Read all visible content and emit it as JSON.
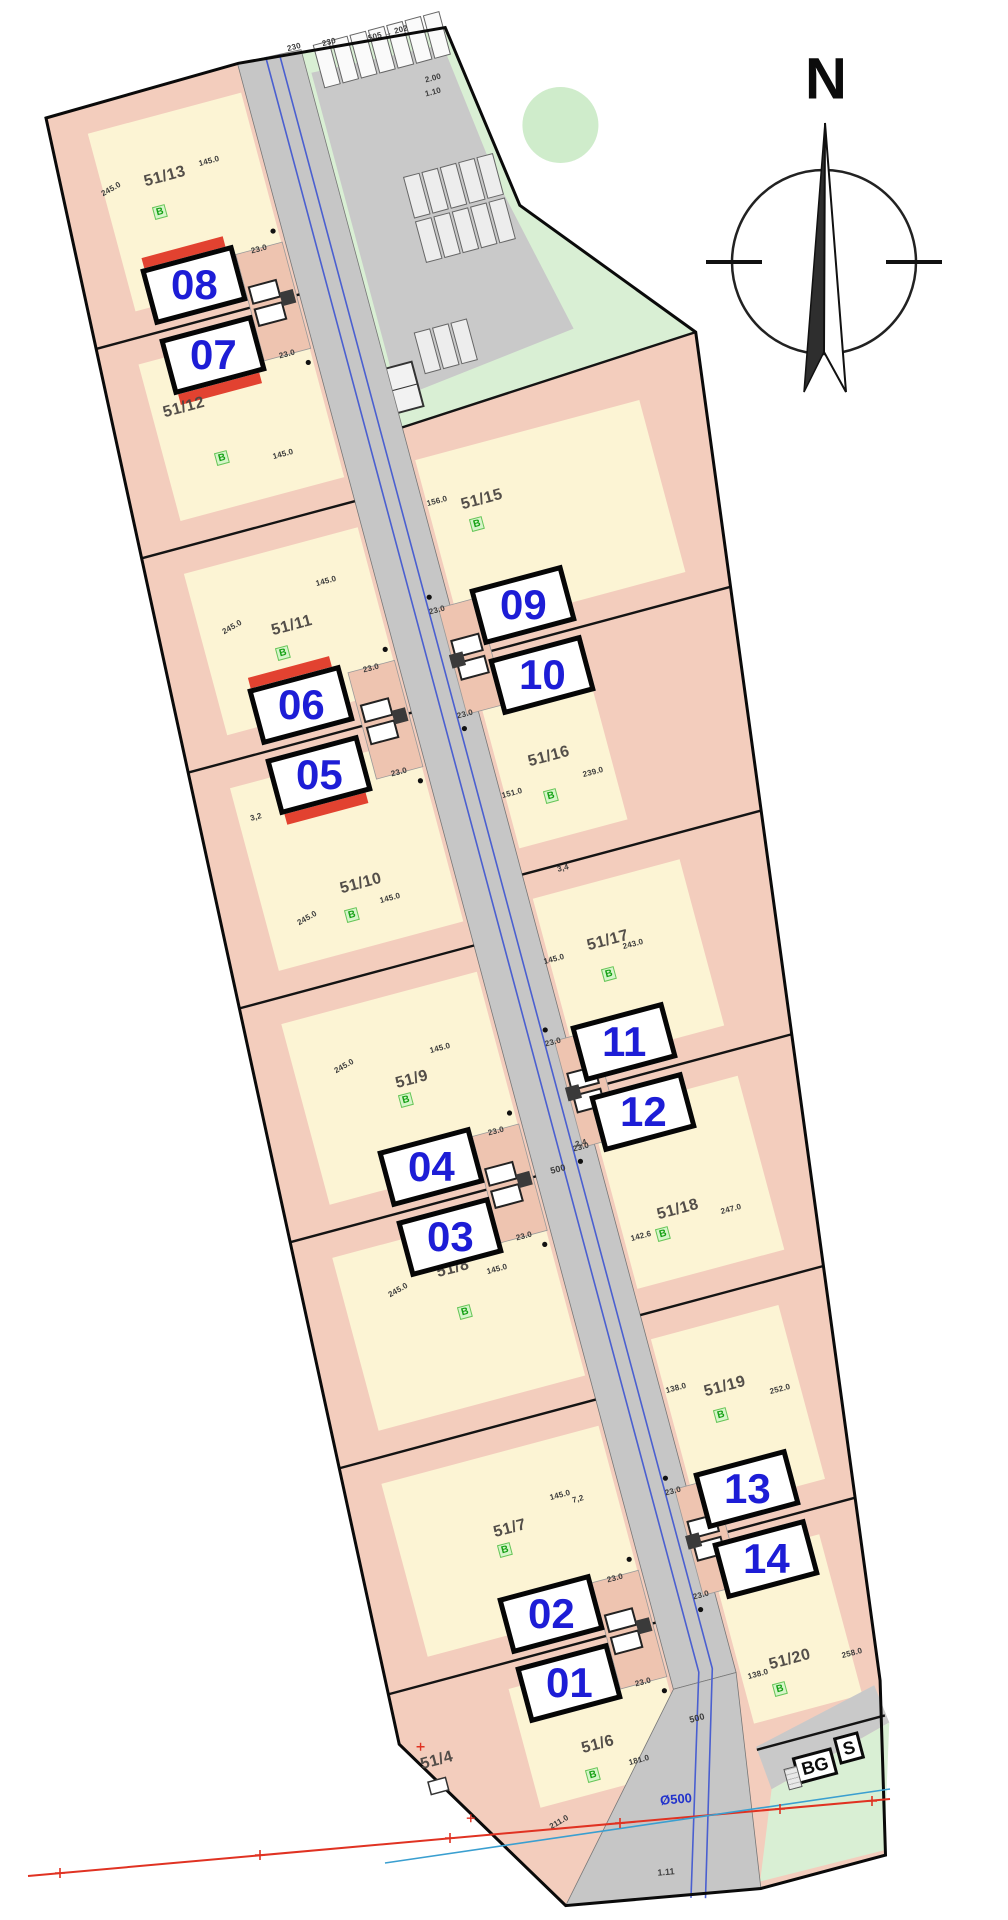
{
  "compass": {
    "label": "N"
  },
  "signs": {
    "bg": "BG",
    "s": "S"
  },
  "utilities": {
    "pipe_label": "Ø500",
    "dim_label": "1.11"
  },
  "road": {
    "labels": [
      {
        "t": "500",
        "p": [
          222,
          1148
        ]
      },
      {
        "t": "500",
        "p": [
          214,
          1714
        ]
      }
    ]
  },
  "parking": {
    "dims": [
      {
        "t": "230",
        "p": [
          258,
          -4
        ]
      },
      {
        "t": "230",
        "p": [
          293,
          0
        ]
      },
      {
        "t": "505 → 202",
        "p": [
          352,
          6
        ]
      },
      {
        "t": "2.00",
        "p": [
          384,
          62
        ]
      },
      {
        "t": "1.10",
        "p": [
          381,
          75
        ]
      }
    ]
  },
  "misc_dims": [
    {
      "t": "3,2",
      "p": [
        22,
        729
      ]
    },
    {
      "t": "2,4",
      "p": [
        251,
        1128
      ]
    },
    {
      "t": "3,4",
      "p": [
        305,
        858
      ]
    },
    {
      "t": "7,2",
      "p": [
        156,
        1471
      ]
    }
  ],
  "parcels": [
    {
      "label": "51/13",
      "pos": [
        100,
        88
      ],
      "marker": "B",
      "marker_pos": [
        86,
        120
      ],
      "dims": [
        {
          "t": "245.0",
          "p": [
            44,
            85
          ],
          "r": -30
        },
        {
          "t": "145.0",
          "p": [
            146,
            84
          ]
        }
      ]
    },
    {
      "label": "51/12",
      "pos": [
        58,
        316
      ],
      "marker": "B",
      "marker_pos": [
        82,
        374
      ],
      "dims": [
        {
          "t": "145.0",
          "p": [
            142,
            386
          ]
        }
      ]
    },
    {
      "label": "51/11",
      "pos": [
        106,
        554
      ],
      "marker": "B",
      "marker_pos": [
        90,
        578
      ],
      "dims": [
        {
          "t": "245.0",
          "p": [
            48,
            540
          ],
          "r": -30
        },
        {
          "t": "145.0",
          "p": [
            150,
            520
          ]
        }
      ]
    },
    {
      "label": "51/10",
      "pos": [
        106,
        821
      ],
      "marker": "B",
      "marker_pos": [
        89,
        849
      ],
      "dims": [
        {
          "t": "245.0",
          "p": [
            45,
            840
          ],
          "r": -30
        },
        {
          "t": "145.0",
          "p": [
            130,
            842
          ]
        }
      ]
    },
    {
      "label": "51/9",
      "pos": [
        104,
        1024
      ],
      "marker": "B",
      "marker_pos": [
        93,
        1042
      ],
      "dims": [
        {
          "t": "245.0",
          "p": [
            42,
            993
          ],
          "r": -30
        },
        {
          "t": "145.0",
          "p": [
            140,
            1000
          ]
        }
      ]
    },
    {
      "label": "51/8",
      "pos": [
        95,
        1217
      ],
      "marker": "B",
      "marker_pos": [
        95,
        1262
      ],
      "dims": [
        {
          "t": "245.0",
          "p": [
            36,
            1223
          ],
          "r": -30
        },
        {
          "t": "145.0",
          "p": [
            138,
            1228
          ]
        }
      ]
    },
    {
      "label": "51/7",
      "pos": [
        83,
        1483
      ],
      "marker": "B",
      "marker_pos": [
        72,
        1502
      ],
      "dims": [
        {
          "t": "145.0",
          "p": [
            140,
            1463
          ]
        }
      ]
    },
    {
      "label": "51/6",
      "pos": [
        112,
        1714
      ],
      "marker": "B",
      "marker_pos": [
        99,
        1742
      ],
      "dims": [
        {
          "t": "181.0",
          "p": [
            148,
            1739
          ]
        },
        {
          "t": "211.0",
          "p": [
            54,
            1778
          ],
          "r": -30
        }
      ]
    },
    {
      "label": "51/4",
      "pos": [
        -48,
        1688
      ],
      "dims": []
    },
    {
      "label": "51/15",
      "pos": [
        322,
        482
      ],
      "marker": "B",
      "marker_pos": [
        311,
        504
      ],
      "dims": [
        {
          "t": "156.0",
          "p": [
            278,
            471
          ]
        }
      ]
    },
    {
      "label": "51/16",
      "pos": [
        320,
        747
      ],
      "marker": "B",
      "marker_pos": [
        312,
        785
      ],
      "dims": [
        {
          "t": "151.0",
          "p": [
            275,
            773
          ]
        },
        {
          "t": "239.0",
          "p": [
            359,
            773
          ]
        }
      ]
    },
    {
      "label": "51/17",
      "pos": [
        330,
        940
      ],
      "marker": "B",
      "marker_pos": [
        322,
        972
      ],
      "dims": [
        {
          "t": "145.0",
          "p": [
            273,
            944
          ]
        },
        {
          "t": "243.0",
          "p": [
            353,
            950
          ]
        }
      ]
    },
    {
      "label": "51/18",
      "pos": [
        328,
        1218
      ],
      "marker": "B",
      "marker_pos": [
        307,
        1238
      ],
      "dims": [
        {
          "t": "142.6",
          "p": [
            285,
            1234
          ]
        },
        {
          "t": "247.0",
          "p": [
            379,
            1231
          ]
        }
      ]
    },
    {
      "label": "51/19",
      "pos": [
        327,
        1401
      ],
      "marker": "B",
      "marker_pos": [
        316,
        1427
      ],
      "dims": [
        {
          "t": "138.0",
          "p": [
            279,
            1390
          ]
        },
        {
          "t": "252.0",
          "p": [
            380,
            1418
          ]
        }
      ]
    },
    {
      "label": "51/20",
      "pos": [
        319,
        1682
      ],
      "marker": "B",
      "marker_pos": [
        302,
        1707
      ],
      "dims": [
        {
          "t": "138.0",
          "p": [
            285,
            1687
          ]
        },
        {
          "t": "258.0",
          "p": [
            381,
            1691
          ]
        }
      ]
    }
  ],
  "houses": [
    {
      "units": [
        "08",
        "07"
      ],
      "center": [
        100,
        236
      ],
      "side": "left",
      "red": true,
      "garage_dims": [
        "23.0",
        "23.0"
      ]
    },
    {
      "units": [
        "06",
        "05"
      ],
      "center": [
        94,
        669
      ],
      "side": "left",
      "red": true,
      "garage_dims": [
        "23.0",
        "23.0"
      ]
    },
    {
      "units": [
        "04",
        "03"
      ],
      "center": [
        100,
        1149
      ],
      "side": "left",
      "red": false,
      "garage_dims": [
        "23.0",
        "23.0"
      ]
    },
    {
      "units": [
        "02",
        "01"
      ],
      "center": [
        100,
        1611
      ],
      "side": "left",
      "red": false,
      "garage_dims": [
        "23.0",
        "23.0"
      ]
    },
    {
      "units": [
        "09",
        "10"
      ],
      "center": [
        335,
        630
      ],
      "side": "right",
      "red": false,
      "garage_dims": [
        "23.0",
        "23.0"
      ]
    },
    {
      "units": [
        "11",
        "12"
      ],
      "center": [
        319,
        1078
      ],
      "side": "right",
      "red": false,
      "garage_dims": [
        "23.0",
        "23.0"
      ]
    },
    {
      "units": [
        "13",
        "14"
      ],
      "center": [
        322,
        1542
      ],
      "side": "right",
      "red": false,
      "garage_dims": [
        "23.0",
        "23.0"
      ]
    }
  ],
  "colors": {
    "house_number_blue": "#1d1dd6",
    "parcel_pink": "#f3cdbd",
    "plot_cream": "#fcf4d4",
    "road_gray": "#c6c6c6",
    "green_area": "#d9efd4",
    "accent_red": "#e03222",
    "pipe_blue": "#2233cc",
    "marker_green": "#13a013"
  }
}
